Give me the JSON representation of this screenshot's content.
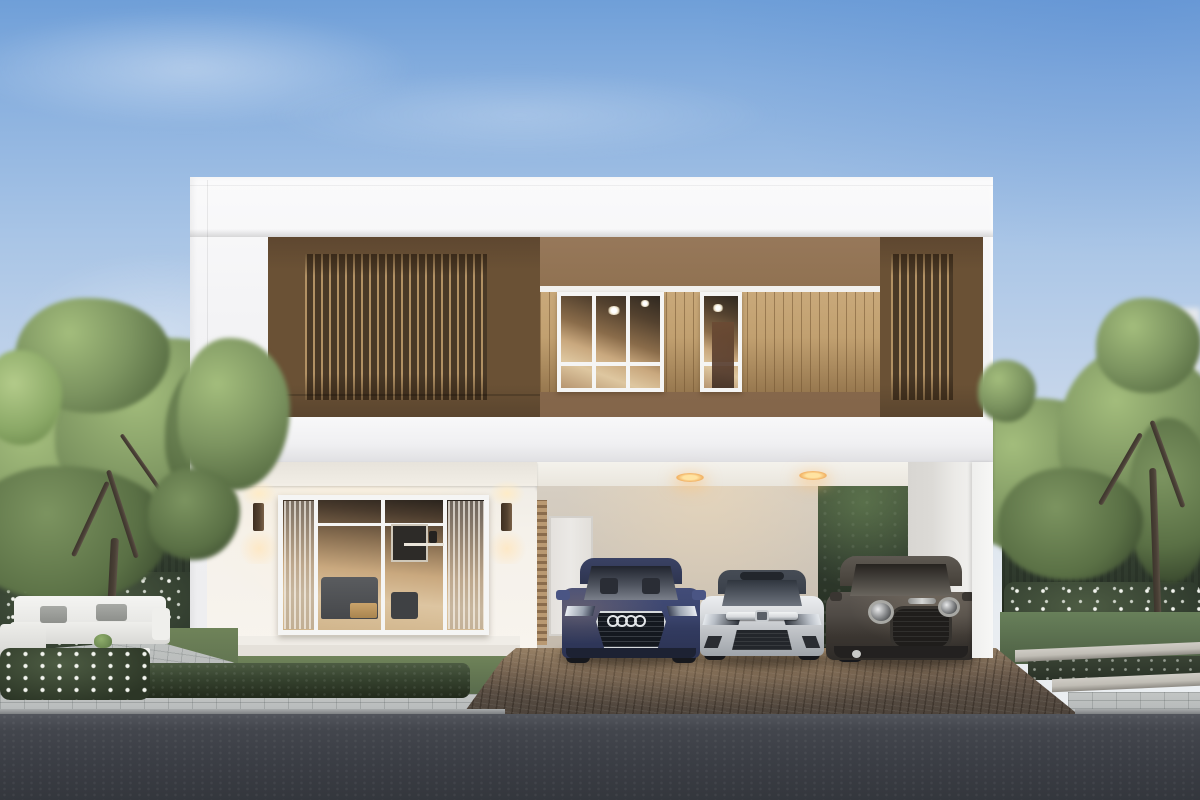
{
  "scene": {
    "type": "architectural-exterior-render",
    "time_of_day": "dusk",
    "summary": "Modern two-story white house with brown wood-slat upper facade, lit carport with three parked cars, glass living-room wall, gardens with trees and hedges, cobblestone driveway and asphalt road"
  },
  "objects": {
    "house_label": "modern two-story white house with brown slat facade",
    "upper_windows_label": "upper floor windows in wood plank wall",
    "lower_window_label": "sliding glass wall showing living room with sofa",
    "sconce_label": "warm wall sconce light",
    "carport_label": "carport with recessed ceiling lights and side door",
    "car_left_label": "navy blue Audi crossover with four-ring grille badge",
    "car_middle_label": "silver Honda Civic sedan with chrome grille bar",
    "car_right_label": "dark gray Mini Countryman SUV with round headlights",
    "sofa_label": "white outdoor sofa set with coffee table and plant",
    "garden_left_label": "left garden with trees, hedge wall and white flowers",
    "garden_right_label": "right garden with planter curbs and flower bed",
    "hedge_row_label": "trimmed box hedge along sidewalk",
    "driveway_label": "brown cobblestone driveway",
    "sidewalk_label": "gray paver sidewalk",
    "road_label": "dark asphalt road",
    "background_label": "distant white buildings behind trees"
  },
  "palette": {
    "sky_top": "#6f9fd8",
    "sky_mid": "#a9c5e6",
    "sky_horizon": "#e9edf1",
    "bg_building": "#ebe9e5",
    "house_white": "#f3f3f5",
    "panel_brown": "#7d6243",
    "panel_dark_brown": "#6a5135",
    "slat_light": "#b29164",
    "slat_gap": "#4a3926",
    "mid_wall_brown": "#8d6f4e",
    "plank_light": "#c9a97a",
    "plank_groove": "#97784f",
    "trim_white": "#f2f1ee",
    "frame_white": "#f5f5f4",
    "glass_dark": "#2f2820",
    "glass_warm": "#c9a87e",
    "glass_light": "#dec7a0",
    "porch_wall": "#f5f1ea",
    "sconce_body": "#53412f",
    "carport_wall": "#d6cec2",
    "carport_wall_dark": "#c3b9ab",
    "door_white": "#ebe9e6",
    "pillar_light": "#f7f7f6",
    "pillar_shade": "#dcdad6",
    "hedge_dark": "#2f3a2d",
    "hedge_mid": "#3e4b39",
    "hedge_light": "#4d5c43",
    "tree_green": "#7c9460",
    "tree_green_dark": "#5a7045",
    "tree_green_light": "#a3bd7c",
    "trunk": "#4a4036",
    "lawn": "#6f8359",
    "lawn_dark": "#55674a",
    "flower_white": "#f2f4ee",
    "patio_gray": "#b5b8b7",
    "sidewalk_gray": "#b2b6b7",
    "drive_light": "#8d7962",
    "drive_mid": "#6a5a4b",
    "drive_dark": "#4b423a",
    "road_dark": "#3b3e45",
    "road_light": "#53565d",
    "curb": "#a8abac",
    "planter_concrete": "#c0bdb5",
    "planter_shadow": "#8e8b84",
    "audi_body": "#424c78",
    "audi_dark": "#2b3252",
    "civic_body": "#d9dcdf",
    "civic_dark": "#9fa4aa",
    "civic_glass": "#3a404a",
    "mini_body": "#4f4a45",
    "mini_dark": "#2e2b28",
    "mini_glass": "#26231f",
    "chrome": "#d6d9dc"
  }
}
